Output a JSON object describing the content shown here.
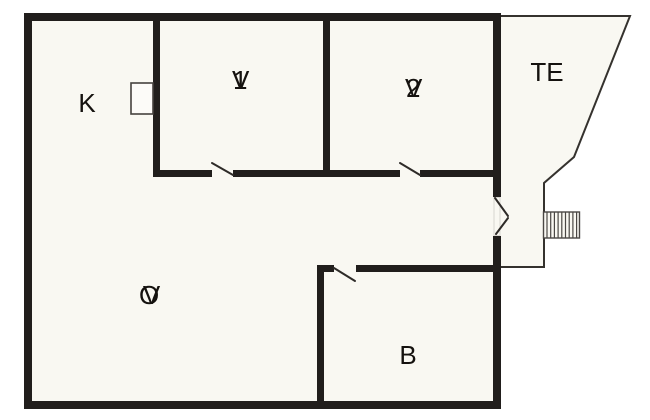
{
  "plan": {
    "rooms": [
      {
        "name": "kitchen",
        "label": "K"
      },
      {
        "name": "bedroom-1",
        "label": "V1"
      },
      {
        "name": "bedroom-2",
        "label": "V2"
      },
      {
        "name": "terrace",
        "label": "TE"
      },
      {
        "name": "living-room",
        "label": "OV"
      },
      {
        "name": "bathroom",
        "label": "B"
      }
    ],
    "colors": {
      "wall": "#211e1c",
      "thin_line": "#35322e",
      "floor": "#f9f8f2",
      "background": "#ffffff",
      "label": "#15120f"
    }
  }
}
